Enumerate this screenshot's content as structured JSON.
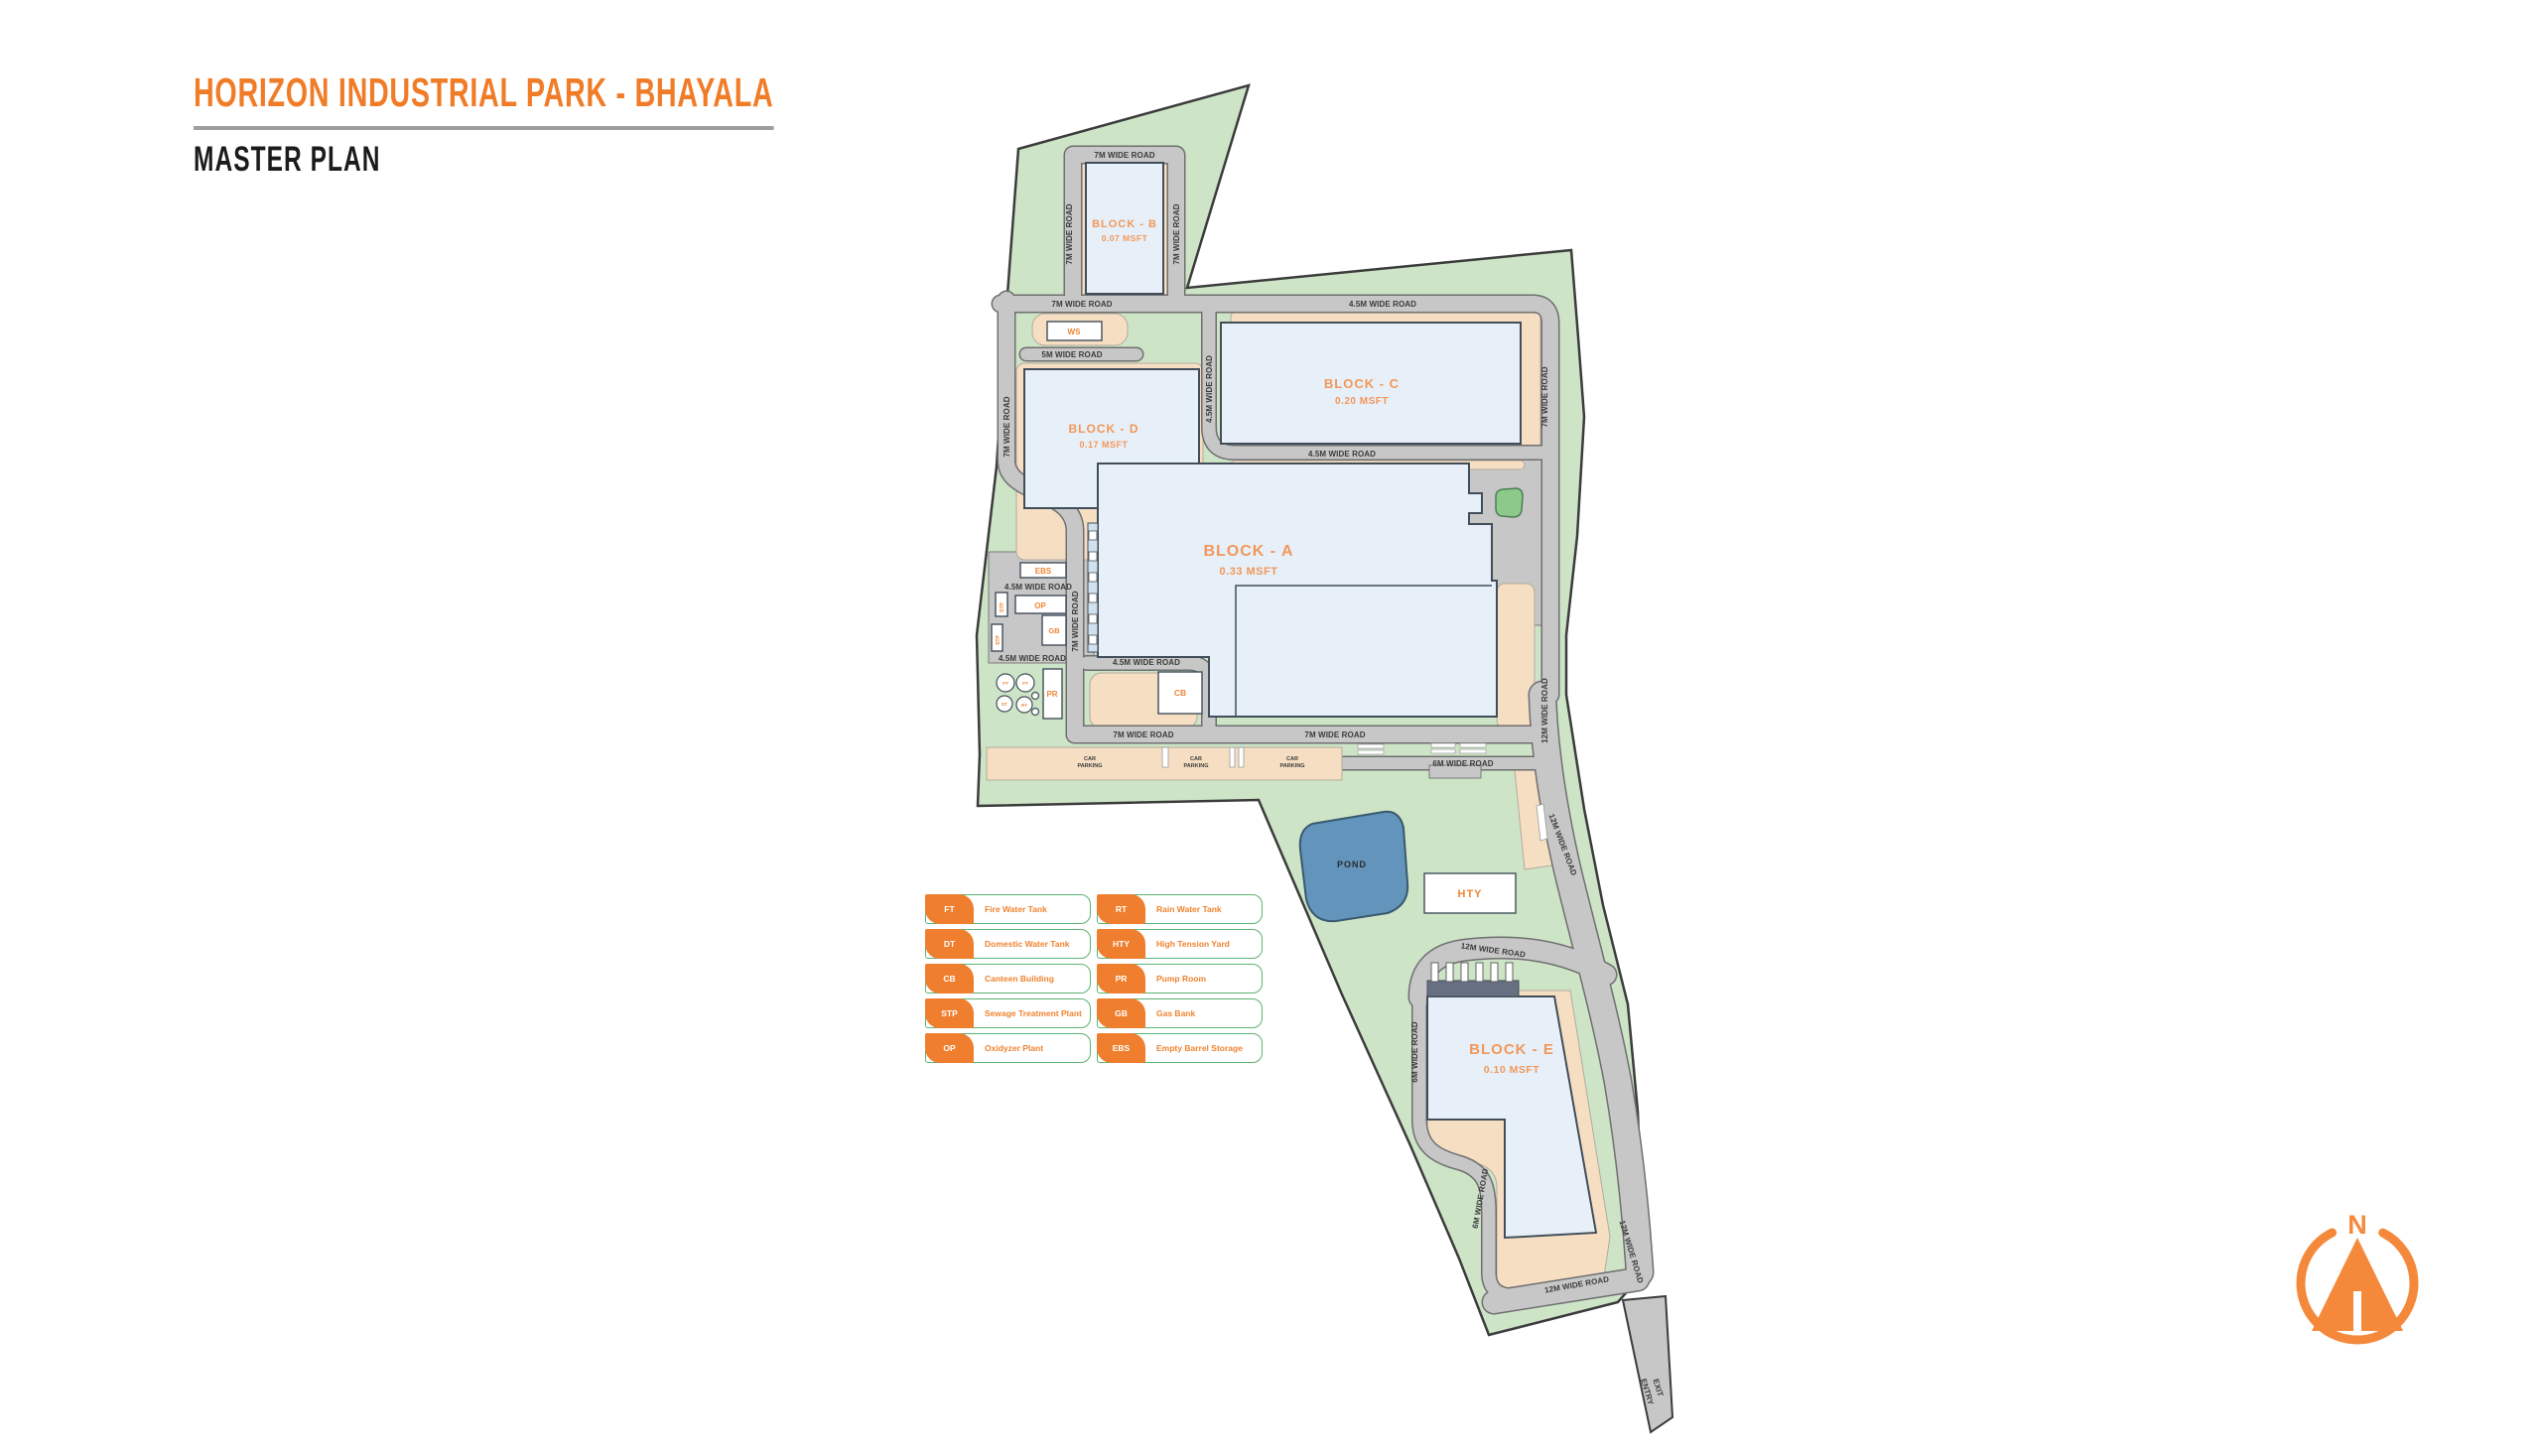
{
  "header": {
    "title": "HORIZON INDUSTRIAL PARK - BHAYALA",
    "subtitle": "MASTER PLAN"
  },
  "legend": {
    "items": [
      {
        "code": "FT",
        "label": "Fire Water Tank"
      },
      {
        "code": "DT",
        "label": "Domestic Water Tank"
      },
      {
        "code": "CB",
        "label": "Canteen Building"
      },
      {
        "code": "STP",
        "label": "Sewage Treatment Plant"
      },
      {
        "code": "OP",
        "label": "Oxidyzer Plant"
      },
      {
        "code": "RT",
        "label": "Rain Water Tank"
      },
      {
        "code": "HTY",
        "label": "High Tension Yard"
      },
      {
        "code": "PR",
        "label": "Pump Room"
      },
      {
        "code": "GB",
        "label": "Gas Bank"
      },
      {
        "code": "EBS",
        "label": "Empty Barrel Storage"
      }
    ]
  },
  "map": {
    "blocks": [
      {
        "name": "BLOCK - A",
        "area": "0.33 MSFT"
      },
      {
        "name": "BLOCK - B",
        "area": "0.07 MSFT"
      },
      {
        "name": "BLOCK - C",
        "area": "0.20 MSFT"
      },
      {
        "name": "BLOCK - D",
        "area": "0.17 MSFT"
      },
      {
        "name": "BLOCK - E",
        "area": "0.10 MSFT"
      }
    ],
    "facilities": {
      "ws": "WS",
      "ebs": "EBS",
      "op": "OP",
      "stp": "STP",
      "gb": "GB",
      "pr": "PR",
      "cb": "CB",
      "hty": "HTY",
      "ft": "FT",
      "dt": "DT",
      "rt": "RT"
    },
    "pond_label": "POND",
    "parking": {
      "line1": "CAR",
      "line2": "PARKING"
    },
    "entry_label": "ENTRY",
    "exit_label": "EXIT",
    "compass_north": "N",
    "road_labels": [
      {
        "text": "7M WIDE ROAD"
      },
      {
        "text": "7M WIDE ROAD"
      },
      {
        "text": "7M WIDE ROAD"
      },
      {
        "text": "7M WIDE ROAD"
      },
      {
        "text": "4.5M WIDE ROAD"
      },
      {
        "text": "5M WIDE ROAD"
      },
      {
        "text": "7M WIDE ROAD"
      },
      {
        "text": "4.5M WIDE ROAD"
      },
      {
        "text": "7M WIDE ROAD"
      },
      {
        "text": "4.5M WIDE ROAD"
      },
      {
        "text": "4.5M WIDE ROAD"
      },
      {
        "text": "7M WIDE ROAD"
      },
      {
        "text": "4.5M WIDE ROAD"
      },
      {
        "text": "4.5M WIDE ROAD"
      },
      {
        "text": "7M WIDE ROAD"
      },
      {
        "text": "7M WIDE ROAD"
      },
      {
        "text": "6M WIDE ROAD"
      },
      {
        "text": "12M WIDE ROAD"
      },
      {
        "text": "12M WIDE ROAD"
      },
      {
        "text": "12M WIDE ROAD"
      },
      {
        "text": "6M WIDE ROAD"
      },
      {
        "text": "6M WIDE ROAD"
      },
      {
        "text": "12M WIDE ROAD"
      },
      {
        "text": "12M WIDE ROAD"
      }
    ]
  },
  "colors": {
    "accent": "#F07C28",
    "site_green": "#CDE4C7",
    "road_gray": "#C7C7C7",
    "apron_tan": "#F6DEC3",
    "building_blue": "#E7F0F8",
    "pond_blue": "#6294BC",
    "legend_green": "#5CB272"
  }
}
